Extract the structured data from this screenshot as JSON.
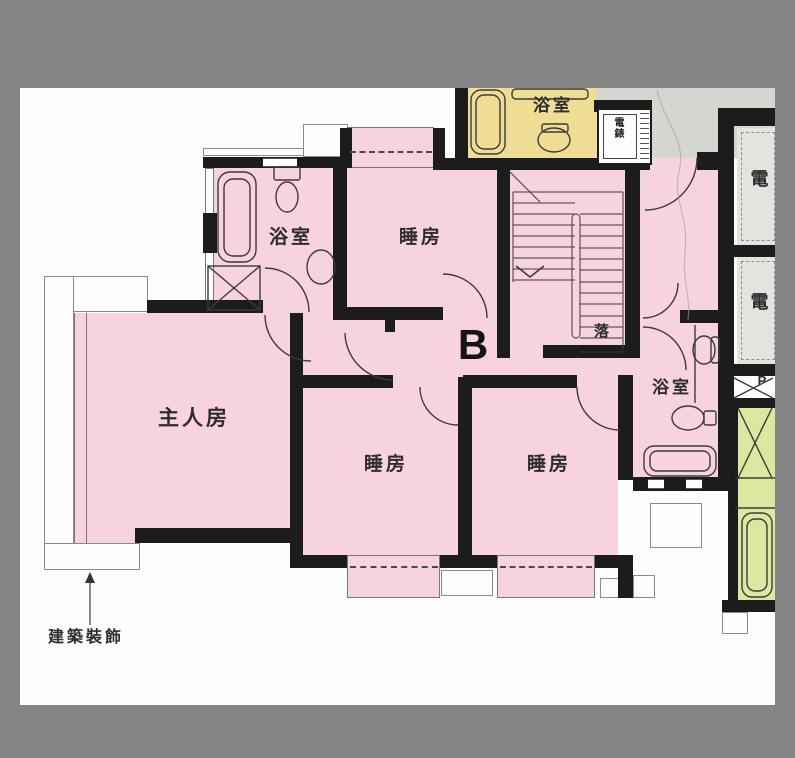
{
  "document": {
    "type": "apartment floor plan",
    "unit_label": "B"
  },
  "rooms": {
    "master_bedroom": "主人房",
    "bedroom_top": "睡房",
    "bedroom_left": "睡房",
    "bedroom_right": "睡房",
    "bathroom_top": "浴室",
    "bathroom_right": "浴室",
    "bathroom_neighbor": "浴室",
    "stair_direction": "落",
    "meter_room_1": "電",
    "meter_room_2": "電",
    "pipe_duct": "P",
    "meter_box": "電錶"
  },
  "annotations": {
    "decoration": "建築裝飾"
  },
  "colors": {
    "matte": "#858585",
    "paper": "#fdfdfb",
    "wall": "#1c1c1c",
    "unit_fill": "#f7d3df",
    "neighbor_bath_fill": "#f0dd94",
    "lobby_fill": "#d6d6d1",
    "meter_fill": "#e3e3df",
    "green_fill": "#dce8a0",
    "line": "#3b3b3b"
  }
}
